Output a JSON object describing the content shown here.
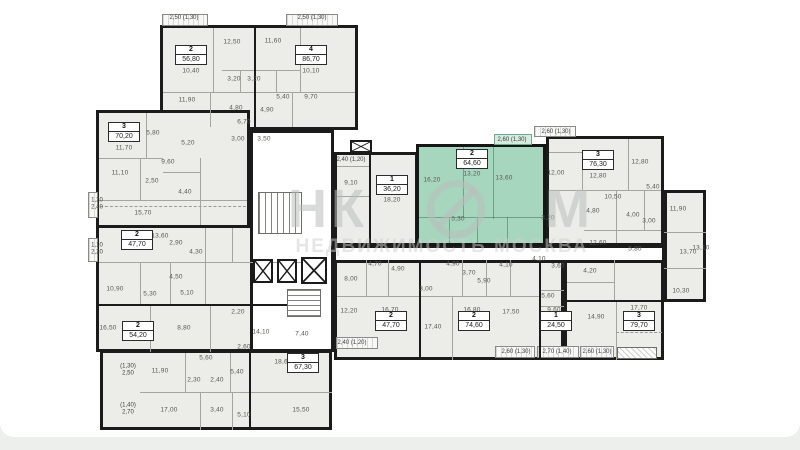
{
  "watermark": {
    "prefix": "НК",
    "suffix": "М",
    "subtitle": "НЕДВИЖИМОСТЬ МОСКВА"
  },
  "palette": {
    "highlight_fill": "#a7d6bf",
    "wall": "#1b1b1b",
    "unit_fill": "#ecede8",
    "label_color": "#575751",
    "page_background": "#edefed"
  },
  "floorplan": {
    "selected_unit": {
      "type": "2",
      "area": "64,60"
    },
    "units": [
      {
        "type": "2",
        "area": "56,80",
        "x": 191,
        "y": 55,
        "highlighted": false
      },
      {
        "type": "4",
        "area": "86,70",
        "x": 311,
        "y": 55,
        "highlighted": false
      },
      {
        "type": "3",
        "area": "70,20",
        "x": 124,
        "y": 132,
        "highlighted": false
      },
      {
        "type": "2",
        "area": "47,70",
        "x": 137,
        "y": 240,
        "highlighted": false
      },
      {
        "type": "2",
        "area": "54,20",
        "x": 138,
        "y": 331,
        "highlighted": false
      },
      {
        "type": "3",
        "area": "67,30",
        "x": 303,
        "y": 363,
        "highlighted": false
      },
      {
        "type": "1",
        "area": "36,20",
        "x": 392,
        "y": 185,
        "highlighted": false
      },
      {
        "type": "2",
        "area": "64,60",
        "x": 472,
        "y": 159,
        "highlighted": true
      },
      {
        "type": "3",
        "area": "76,30",
        "x": 598,
        "y": 160,
        "highlighted": false
      },
      {
        "type": "2",
        "area": "47,70",
        "x": 391,
        "y": 321,
        "highlighted": false
      },
      {
        "type": "2",
        "area": "74,60",
        "x": 474,
        "y": 321,
        "highlighted": false
      },
      {
        "type": "1",
        "area": "24,50",
        "x": 556,
        "y": 321,
        "highlighted": false
      },
      {
        "type": "3",
        "area": "79,70",
        "x": 639,
        "y": 321,
        "highlighted": false
      }
    ],
    "room_labels": [
      {
        "t": "12,50",
        "x": 232,
        "y": 42
      },
      {
        "t": "11,60",
        "x": 273,
        "y": 41
      },
      {
        "t": "10,40",
        "x": 191,
        "y": 71
      },
      {
        "t": "10,10",
        "x": 311,
        "y": 71
      },
      {
        "t": "3,20",
        "x": 234,
        "y": 79
      },
      {
        "t": "3,20",
        "x": 254,
        "y": 79
      },
      {
        "t": "5,40",
        "x": 283,
        "y": 97
      },
      {
        "t": "9,70",
        "x": 311,
        "y": 97
      },
      {
        "t": "11,90",
        "x": 187,
        "y": 100
      },
      {
        "t": "4,80",
        "x": 236,
        "y": 108
      },
      {
        "t": "4,90",
        "x": 267,
        "y": 110
      },
      {
        "t": "6,70",
        "x": 244,
        "y": 122
      },
      {
        "t": "3,00",
        "x": 238,
        "y": 139
      },
      {
        "t": "3,50",
        "x": 264,
        "y": 139
      },
      {
        "t": "11,70",
        "x": 124,
        "y": 148
      },
      {
        "t": "5,80",
        "x": 153,
        "y": 133
      },
      {
        "t": "5,20",
        "x": 188,
        "y": 143
      },
      {
        "t": "9,60",
        "x": 168,
        "y": 162
      },
      {
        "t": "11,10",
        "x": 120,
        "y": 173
      },
      {
        "t": "2,50",
        "x": 152,
        "y": 181
      },
      {
        "t": "4,40",
        "x": 185,
        "y": 192
      },
      {
        "t": "15,70",
        "x": 143,
        "y": 213
      },
      {
        "t": "13,60",
        "x": 160,
        "y": 236
      },
      {
        "t": "2,90",
        "x": 176,
        "y": 243
      },
      {
        "t": "4,30",
        "x": 196,
        "y": 252
      },
      {
        "t": "4,50",
        "x": 176,
        "y": 277
      },
      {
        "t": "10,90",
        "x": 115,
        "y": 289
      },
      {
        "t": "5,30",
        "x": 150,
        "y": 294
      },
      {
        "t": "5,10",
        "x": 187,
        "y": 293
      },
      {
        "t": "16,50",
        "x": 108,
        "y": 328
      },
      {
        "t": "8,80",
        "x": 184,
        "y": 328
      },
      {
        "t": "2,20",
        "x": 238,
        "y": 312
      },
      {
        "t": "14,10",
        "x": 261,
        "y": 332
      },
      {
        "t": "7,40",
        "x": 302,
        "y": 334
      },
      {
        "t": "2,60",
        "x": 244,
        "y": 347
      },
      {
        "t": "5,60",
        "x": 206,
        "y": 358
      },
      {
        "t": "11,90",
        "x": 160,
        "y": 371
      },
      {
        "t": "5,40",
        "x": 237,
        "y": 372
      },
      {
        "t": "2,30",
        "x": 194,
        "y": 380
      },
      {
        "t": "2,40",
        "x": 217,
        "y": 380
      },
      {
        "t": "18,60",
        "x": 283,
        "y": 362
      },
      {
        "t": "17,00",
        "x": 169,
        "y": 410
      },
      {
        "t": "3,40",
        "x": 217,
        "y": 410
      },
      {
        "t": "5,10",
        "x": 244,
        "y": 415
      },
      {
        "t": "15,50",
        "x": 301,
        "y": 410
      },
      {
        "t": "9,10",
        "x": 351,
        "y": 183
      },
      {
        "t": "18,20",
        "x": 392,
        "y": 200
      },
      {
        "t": "16,20",
        "x": 432,
        "y": 180
      },
      {
        "t": "13,20",
        "x": 472,
        "y": 174
      },
      {
        "t": "13,60",
        "x": 504,
        "y": 178
      },
      {
        "t": "5,30",
        "x": 458,
        "y": 219
      },
      {
        "t": "12,00",
        "x": 556,
        "y": 173
      },
      {
        "t": "3,20",
        "x": 548,
        "y": 218
      },
      {
        "t": "12,80",
        "x": 598,
        "y": 176
      },
      {
        "t": "12,80",
        "x": 640,
        "y": 162
      },
      {
        "t": "10,50",
        "x": 613,
        "y": 197
      },
      {
        "t": "4,80",
        "x": 593,
        "y": 211
      },
      {
        "t": "4,00",
        "x": 633,
        "y": 215
      },
      {
        "t": "3,00",
        "x": 649,
        "y": 221
      },
      {
        "t": "5,40",
        "x": 653,
        "y": 187
      },
      {
        "t": "11,90",
        "x": 678,
        "y": 209
      },
      {
        "t": "12,60",
        "x": 598,
        "y": 243
      },
      {
        "t": "5,80",
        "x": 635,
        "y": 249
      },
      {
        "t": "13,10",
        "x": 701,
        "y": 248
      },
      {
        "t": "4,70",
        "x": 375,
        "y": 264
      },
      {
        "t": "4,90",
        "x": 398,
        "y": 269
      },
      {
        "t": "8,00",
        "x": 351,
        "y": 279
      },
      {
        "t": "12,20",
        "x": 349,
        "y": 311
      },
      {
        "t": "16,70",
        "x": 390,
        "y": 310
      },
      {
        "t": "3,00",
        "x": 426,
        "y": 289
      },
      {
        "t": "17,40",
        "x": 433,
        "y": 327
      },
      {
        "t": "4,90",
        "x": 453,
        "y": 264
      },
      {
        "t": "3,70",
        "x": 469,
        "y": 273
      },
      {
        "t": "5,90",
        "x": 484,
        "y": 281
      },
      {
        "t": "16,80",
        "x": 472,
        "y": 310
      },
      {
        "t": "4,10",
        "x": 506,
        "y": 265
      },
      {
        "t": "17,50",
        "x": 511,
        "y": 312
      },
      {
        "t": "4,10",
        "x": 539,
        "y": 259
      },
      {
        "t": "3,60",
        "x": 558,
        "y": 266
      },
      {
        "t": "5,60",
        "x": 548,
        "y": 296
      },
      {
        "t": "9,60",
        "x": 554,
        "y": 310
      },
      {
        "t": "4,20",
        "x": 590,
        "y": 271
      },
      {
        "t": "14,90",
        "x": 596,
        "y": 317
      },
      {
        "t": "17,70",
        "x": 639,
        "y": 308
      },
      {
        "t": "13,70",
        "x": 688,
        "y": 252
      },
      {
        "t": "10,30",
        "x": 681,
        "y": 291
      }
    ],
    "balcony_labels": [
      {
        "t": "2,50 (1,30)",
        "x": 184,
        "y": 18
      },
      {
        "t": "2,50 (1,30)",
        "x": 312,
        "y": 18
      },
      {
        "t": "1,20\n2,40",
        "x": 97,
        "y": 204
      },
      {
        "t": "1,10\n2,20",
        "x": 97,
        "y": 249
      },
      {
        "t": "(1,30)\n2,50",
        "x": 128,
        "y": 370
      },
      {
        "t": "(1,40)\n2,70",
        "x": 128,
        "y": 409
      },
      {
        "t": "2,40 (1,20)",
        "x": 351,
        "y": 160
      },
      {
        "t": "2,60 (1,30)",
        "x": 512,
        "y": 140
      },
      {
        "t": "2,60 (1,30)",
        "x": 556,
        "y": 132
      },
      {
        "t": "2,40 (1,20)",
        "x": 352,
        "y": 343
      },
      {
        "t": "2,60 (1,30)",
        "x": 516,
        "y": 352
      },
      {
        "t": "2,70 (1,40)",
        "x": 557,
        "y": 352
      },
      {
        "t": "2,60 (1,30)",
        "x": 597,
        "y": 352
      }
    ]
  }
}
